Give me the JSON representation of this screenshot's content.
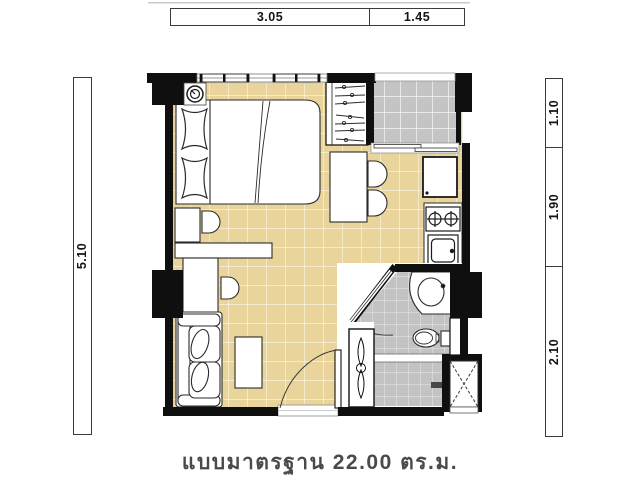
{
  "caption": {
    "text": "แบบมาตรฐาน 22.00 ตร.ม."
  },
  "dimension_bars": {
    "top": {
      "segments": [
        {
          "value": "3.05"
        },
        {
          "value": "1.45"
        }
      ]
    },
    "left": {
      "segments": [
        {
          "value": "5.10"
        }
      ]
    },
    "right": {
      "segments": [
        {
          "value": "1.10"
        },
        {
          "value": "1.90"
        },
        {
          "value": "2.10"
        }
      ]
    }
  },
  "floor_plan": {
    "features": [
      "double-bed",
      "pillows",
      "wardrobe-with-hangers",
      "balcony",
      "sliding-door",
      "dining-table",
      "dining-chairs",
      "refrigerator",
      "stove-two-burners",
      "kitchen-sink",
      "bathroom",
      "washbasin",
      "toilet",
      "shower",
      "floor-drain",
      "service-shaft",
      "sofa",
      "coffee-table",
      "desk",
      "vanity-chair",
      "entrance-door",
      "built-in-cabinet",
      "ceiling-light-symbol",
      "windows"
    ],
    "colors": {
      "room_tile": "#e9d59c",
      "balcony_tile": "#c4c4c4",
      "bath_tile": "#c4c4c4",
      "wall": "#0f0f0f",
      "line": "#2b2b2b",
      "caption": "#4a4a4a"
    }
  }
}
